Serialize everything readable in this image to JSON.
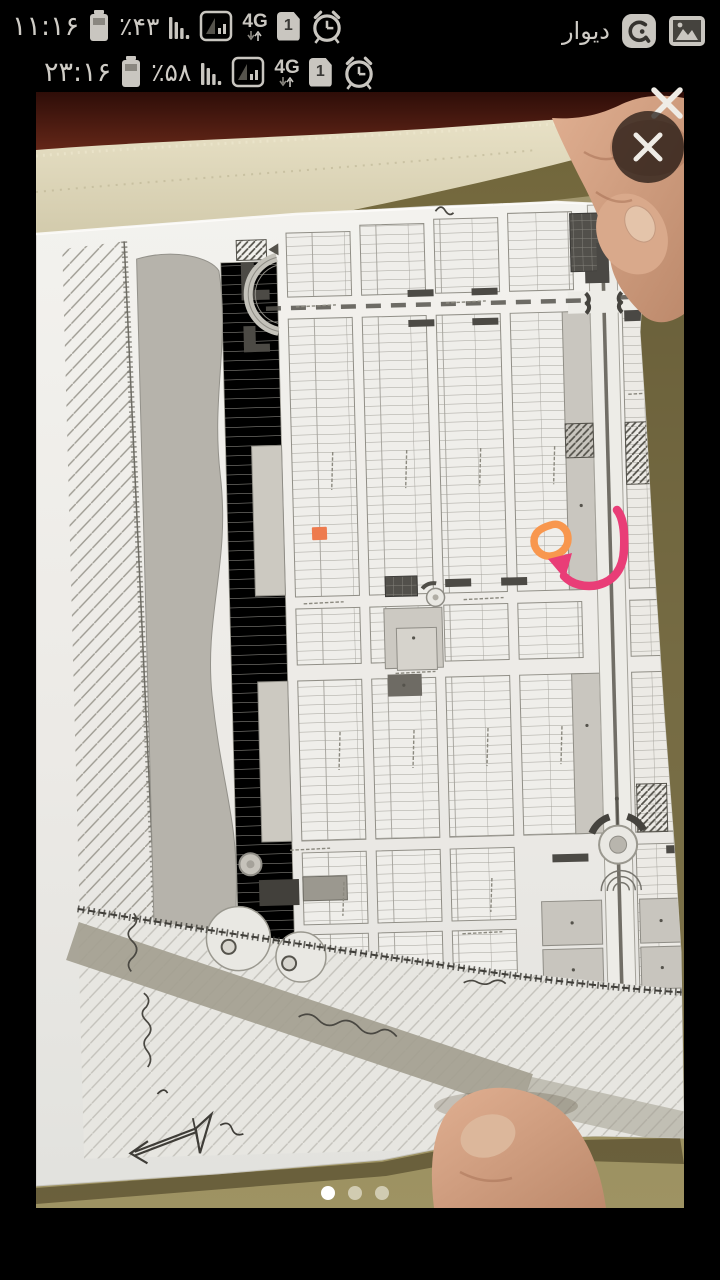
{
  "outer_status_bar": {
    "time": "۱۱:۱۶",
    "battery_percent": "٪۴۳",
    "network_type": "4G",
    "sim_number": "1",
    "notification_app": "ديوار"
  },
  "inner_status_bar": {
    "time": "۲۳:۱۶",
    "battery_percent": "٪۵۸",
    "network_type": "4G",
    "sim_number": "1"
  },
  "viewer": {
    "carousel_dot_count": 3,
    "active_dot_index": 1
  },
  "annotations": {
    "highlight_color": "#ee7b4e",
    "circle_color": "#f8974e",
    "arrow_color": "#e93d77"
  }
}
